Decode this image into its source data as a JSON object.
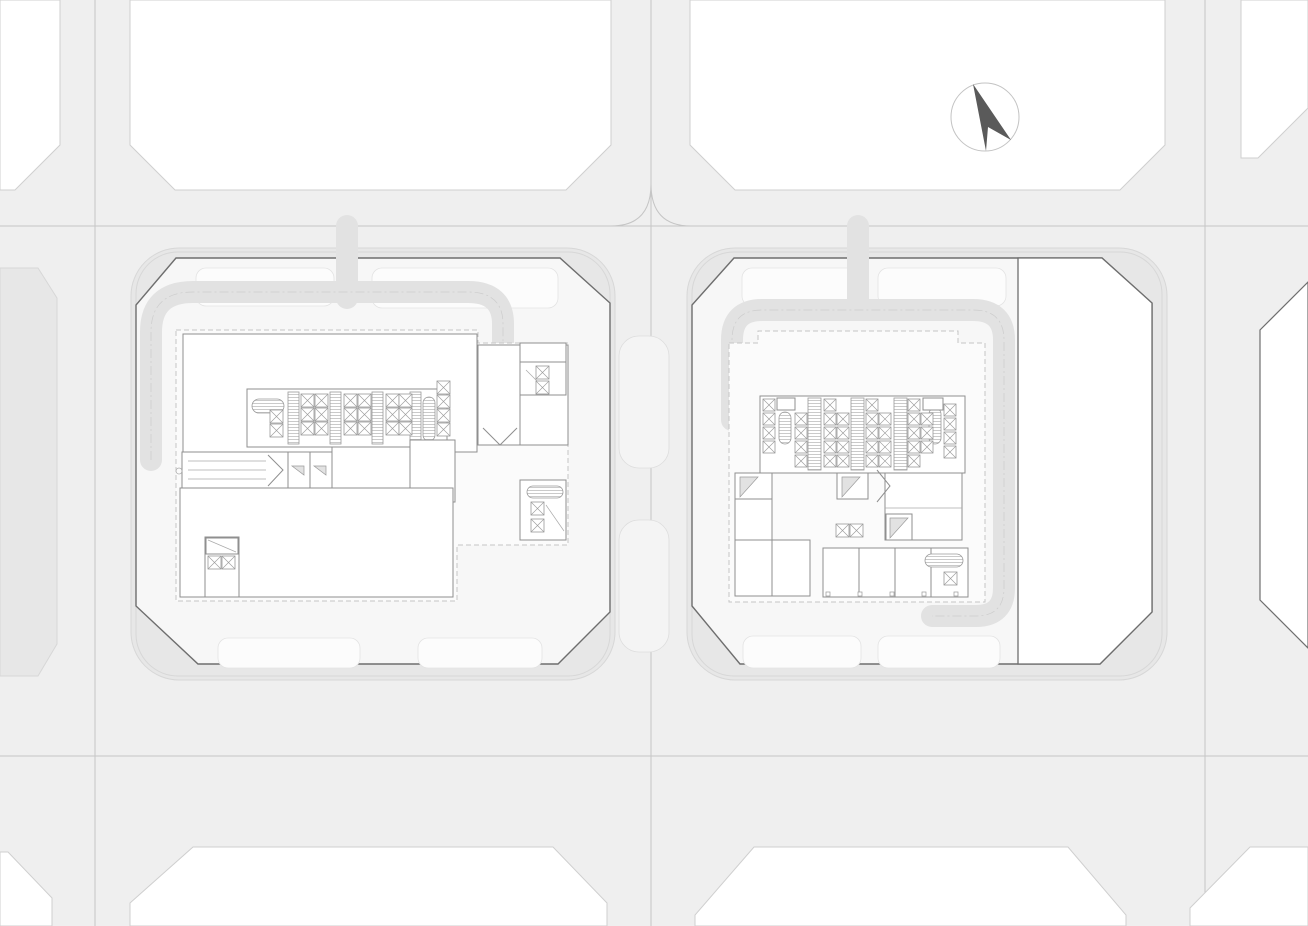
{
  "description": "Architectural site plan drawing: street grid with two chamfered-corner city blocks containing detailed tower ground-floor plans (elevator cores, escalator banks, stairs), surrounding partial blocks and a north arrow",
  "compass": {
    "direction": "N",
    "icon": "north-arrow-icon"
  },
  "palette": {
    "street": "#efefef",
    "centerline": "#c5c5c5",
    "block": "#ffffff",
    "blockstroke": "#cfcfcf",
    "sidewalk": "#e7e7e7",
    "curb": "#d7d7d7",
    "ground": "#f7f7f7",
    "plaza": "#fcfcfc",
    "outline": "#6e6e6e",
    "wall": "#8f8f8f",
    "dashed": "#c6c6c6",
    "walkway": "#e2e2e2",
    "needle": "#5a5a5a",
    "ring": "#c3c3c3",
    "canopy": "#fbfbfb"
  },
  "streets": {
    "vertical_centerlines": [
      95,
      651,
      1205
    ],
    "horizontal_centerlines": [
      226,
      756
    ]
  },
  "plazas": [
    [
      196,
      268,
      138,
      38
    ],
    [
      372,
      268,
      186,
      40
    ],
    [
      218,
      638,
      142,
      30
    ],
    [
      418,
      638,
      124,
      30
    ],
    [
      742,
      268,
      118,
      38
    ],
    [
      878,
      268,
      128,
      38
    ],
    [
      743,
      636,
      118,
      32
    ],
    [
      878,
      636,
      122,
      32
    ]
  ],
  "street_bays": [
    [
      619,
      336,
      50,
      132
    ],
    [
      619,
      520,
      50,
      132
    ]
  ],
  "cores": [
    {
      "id": "west-tower-core",
      "band": [
        247,
        389,
        200,
        58
      ],
      "bars": {
        "xs": [
          288,
          330,
          372,
          410
        ],
        "y": 392,
        "w": 11,
        "h": 52
      },
      "ovals": [
        {
          "x": 252,
          "y": 399,
          "w": 32,
          "h": 14
        },
        {
          "x": 423,
          "y": 397,
          "w": 12,
          "h": 44
        }
      ],
      "box": 13,
      "box_cols": [
        {
          "x": 270,
          "rows": [
            410,
            424
          ]
        },
        {
          "x": 301,
          "rows": [
            394,
            408,
            422
          ]
        },
        {
          "x": 315,
          "rows": [
            394,
            408,
            422
          ]
        },
        {
          "x": 344,
          "rows": [
            394,
            408,
            422
          ]
        },
        {
          "x": 358,
          "rows": [
            394,
            408,
            422
          ]
        },
        {
          "x": 386,
          "rows": [
            394,
            408,
            422
          ]
        },
        {
          "x": 399,
          "rows": [
            394,
            408,
            422
          ]
        },
        {
          "x": 437,
          "rows": [
            381,
            395,
            409,
            423
          ]
        }
      ]
    },
    {
      "id": "east-tower-core",
      "band": [
        760,
        396,
        205,
        77
      ],
      "bars": {
        "xs": [
          808,
          851,
          894
        ],
        "y": 398,
        "w": 13,
        "h": 72
      },
      "ovals": [
        {
          "x": 779,
          "y": 412,
          "w": 12,
          "h": 32
        },
        {
          "x": 929,
          "y": 408,
          "w": 12,
          "h": 36
        }
      ],
      "box": 12,
      "box_cols": [
        {
          "x": 763,
          "rows": [
            399,
            413,
            427,
            441
          ]
        },
        {
          "x": 795,
          "rows": [
            413,
            427,
            441,
            455
          ]
        },
        {
          "x": 824,
          "rows": [
            399,
            413,
            427,
            441,
            455
          ]
        },
        {
          "x": 837,
          "rows": [
            413,
            427,
            441,
            455
          ]
        },
        {
          "x": 866,
          "rows": [
            399,
            413,
            427,
            441,
            455
          ]
        },
        {
          "x": 879,
          "rows": [
            413,
            427,
            441,
            455
          ]
        },
        {
          "x": 908,
          "rows": [
            399,
            413,
            427,
            441,
            455
          ]
        },
        {
          "x": 921,
          "rows": [
            413,
            427,
            441
          ]
        },
        {
          "x": 944,
          "rows": [
            404,
            418,
            432,
            446
          ]
        }
      ]
    }
  ],
  "misc_xboxes": [
    [
      536,
      366
    ],
    [
      536,
      381
    ],
    [
      531,
      502
    ],
    [
      531,
      519
    ],
    [
      208,
      556
    ],
    [
      222,
      556
    ],
    [
      836,
      524
    ],
    [
      850,
      524
    ],
    [
      944,
      572
    ]
  ],
  "misc_ovals": [
    {
      "x": 527,
      "y": 486,
      "w": 36,
      "h": 12
    },
    {
      "x": 925,
      "y": 554,
      "w": 38,
      "h": 13
    }
  ],
  "annex_ticks": {
    "y": 592,
    "xs": [
      826,
      858,
      890,
      922,
      954
    ],
    "size": 4
  }
}
